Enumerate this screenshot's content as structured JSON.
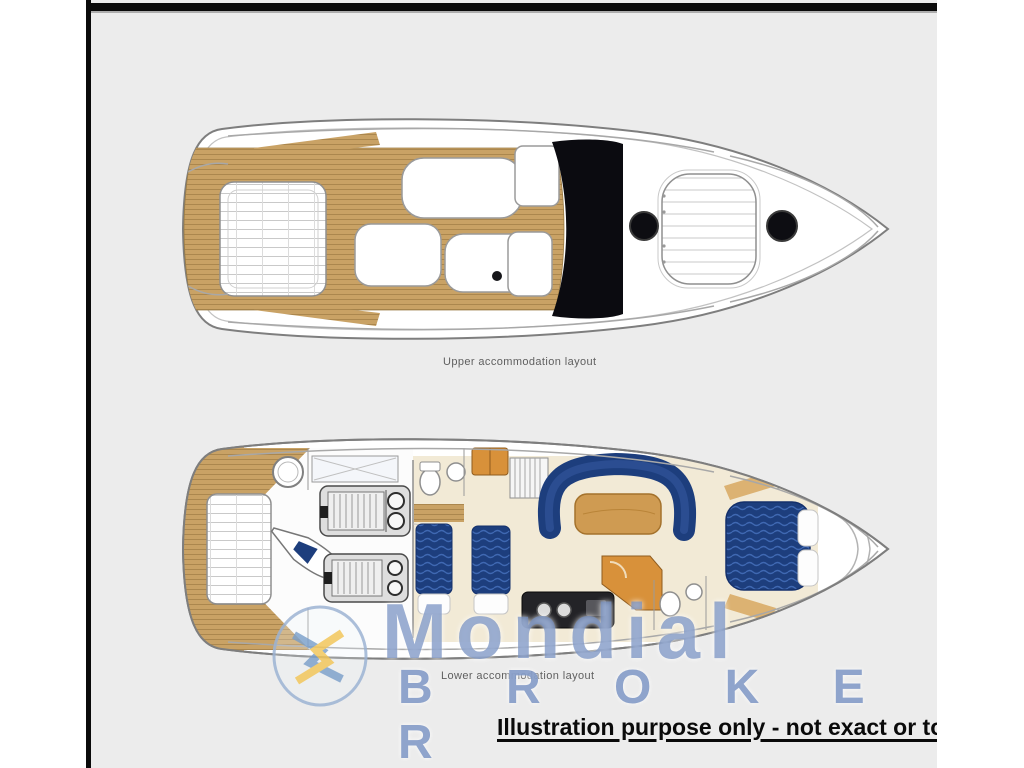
{
  "panel": {
    "background": "#ececec",
    "border_color": "#0a0a0a"
  },
  "upper_plan": {
    "caption": "Upper accommodation layout"
  },
  "lower_plan": {
    "caption": "Lower accommodation layout"
  },
  "watermark": {
    "brand": "Mondial Broker",
    "line1": "Mondial",
    "line2": "B R O K E R",
    "text_color": "#7490c0",
    "logo": "compass-star-logo",
    "logo_blue": "#7fa3cc",
    "logo_yellow": "#f2c75c"
  },
  "disclaimer": {
    "text": "Illustration purpose only - not exact or to sca"
  },
  "palette": {
    "teak_deck": "#c9a265",
    "teak_grain": "#ab874e",
    "hull_outline": "#7e7e7e",
    "glass_black": "#0b0b10",
    "navy_upholstery": "#1d3e7d",
    "navy_wave": "#3f68b2",
    "wood_table": "#cf9b52",
    "cabinet_orange": "#d8913a",
    "floor_cream": "#f2ead6"
  }
}
